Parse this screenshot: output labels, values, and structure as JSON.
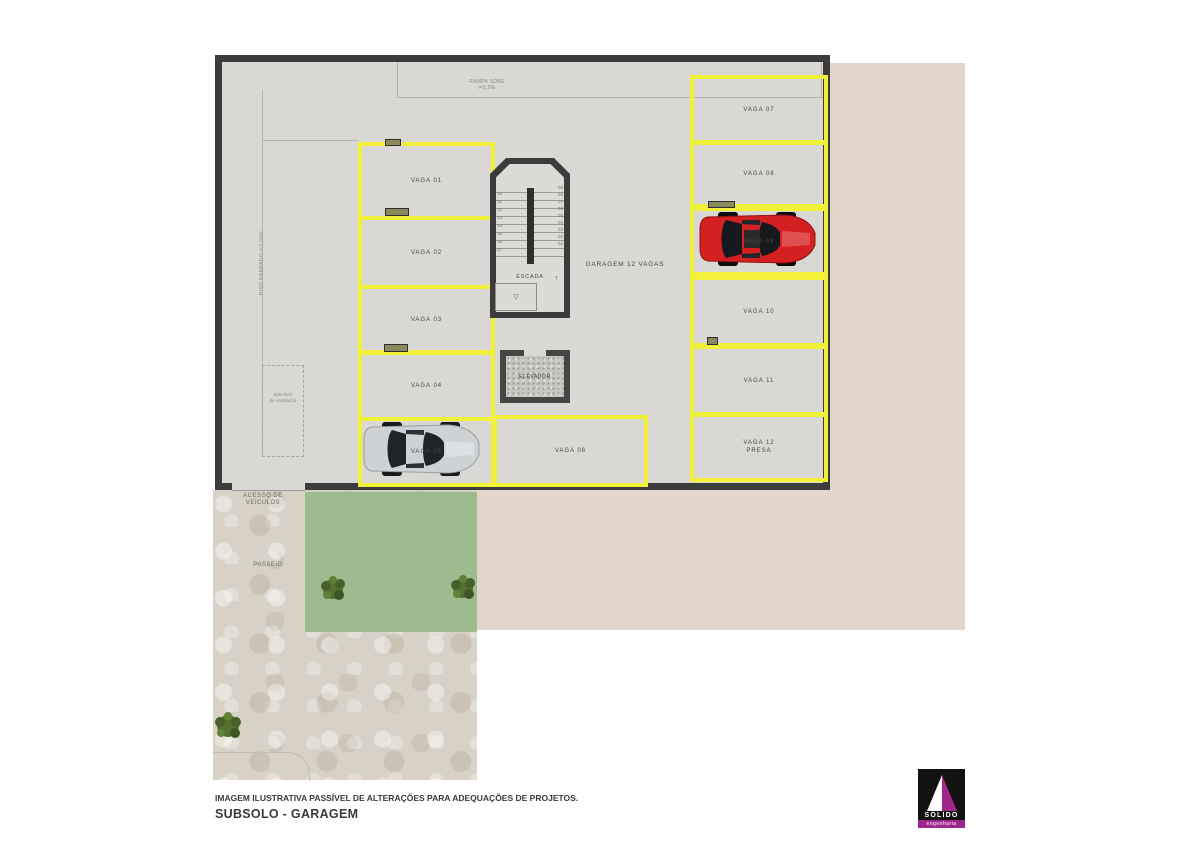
{
  "meta": {
    "disclaimer": "IMAGEM ILUSTRATIVA PASSÍVEL DE ALTERAÇÕES PARA ADEQUAÇÕES DE PROJETOS.",
    "floor_title": "SUBSOLO - GARAGEM"
  },
  "plan": {
    "garage_label": "GARAGEM 12 VAGAS",
    "ramp_label_line1": "RAMPA SOBE",
    "ramp_label_line2": "i=5,5%",
    "sloped_floor_label": "PISO RAMPADO i=2,00%",
    "ventilation_label_line1": "área livre",
    "ventilation_label_line2": "de ventilação",
    "entrance_label_line1": "ACESSO DE",
    "entrance_label_line2": "VEÍCULOS",
    "sidewalk_label": "PASSEIO"
  },
  "stairs": {
    "label": "ESCADA",
    "steps_left": "10\n11\n12\n13\n14\n15\n16\n17",
    "steps_right": "09\n08\n07\n06\n05\n04\n03\n02\n01",
    "up_icon": "↑",
    "drain_icon": "▽"
  },
  "elevator": {
    "label": "ELEVADOR"
  },
  "spaces": [
    {
      "label": "VAGA 01"
    },
    {
      "label": "VAGA 02"
    },
    {
      "label": "VAGA 03"
    },
    {
      "label": "VAGA 04"
    },
    {
      "label": "VAGA 05"
    },
    {
      "label": "VAGA 06"
    },
    {
      "label": "VAGA 07"
    },
    {
      "label": "VAGA 08"
    },
    {
      "label": "VAGA 09"
    },
    {
      "label": "VAGA 10"
    },
    {
      "label": "VAGA 11"
    },
    {
      "label": "VAGA 12",
      "sublabel": "PRESA"
    }
  ],
  "logo": {
    "name": "SÓLIDO",
    "subtitle": "engenharia"
  },
  "colors": {
    "wall": "#3c3c3c",
    "floor": "#d9d8d4",
    "vaga_line": "#f1f13a",
    "lot_pink": "#e4d5cc",
    "grass": "#9dbb8e",
    "paving": "#d8d2c6",
    "tree": "#55702f",
    "car_red": "#d42020",
    "car_silver": "#cfd2d4",
    "logo_magenta": "#a0268c"
  }
}
